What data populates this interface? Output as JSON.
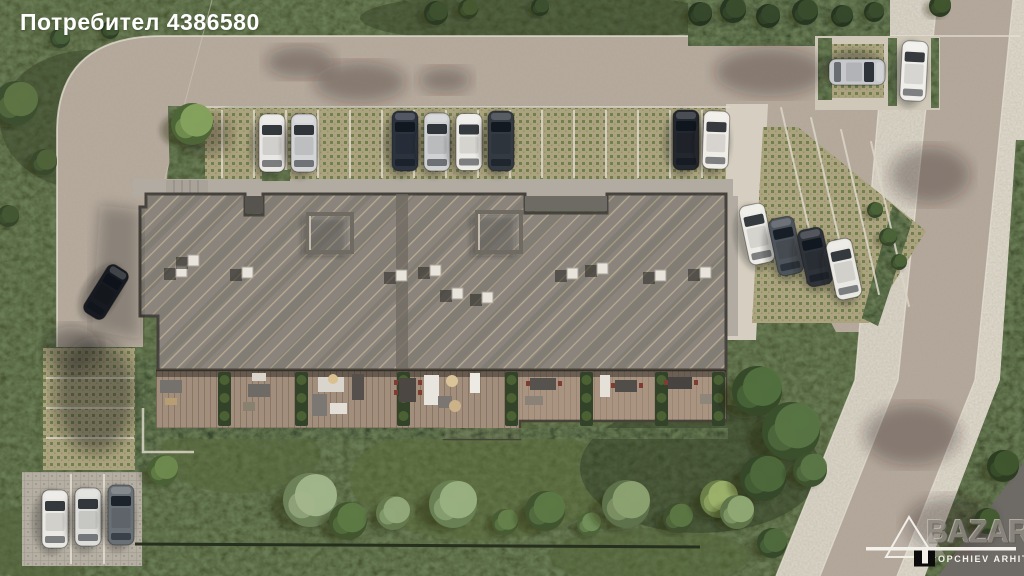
{
  "watermark": {
    "user_label": "Потребител 4386580"
  },
  "logo": {
    "firm_full": "TOPCHIEV ARHITEKTI",
    "firm_initial": "T",
    "firm_rest": "OPCHIEV ARHITEKTI",
    "bazar": "BAZAR"
  },
  "scene": {
    "type": "architectural-aerial-site-render",
    "colors": {
      "grass": "#46522f",
      "grass_dark": "#2f3c22",
      "road": "#b5a89a",
      "sidewalk": "#d8d2c4",
      "paver_tan": "#aba37f",
      "paver_dot_green": "#717f4b",
      "roof": "#8a847c",
      "roof_hatch": "#c7b897",
      "deck": "#a28e7c",
      "hedge": "#35462a",
      "white_line": "#dad4c6"
    },
    "cars": [
      {
        "x": 272,
        "y": 143,
        "a": 0,
        "len": 58,
        "c": "#e9e7e3"
      },
      {
        "x": 304,
        "y": 143,
        "a": 0,
        "len": 58,
        "c": "#d3d4d6"
      },
      {
        "x": 405,
        "y": 141,
        "a": 0,
        "len": 60,
        "c": "#2c333f"
      },
      {
        "x": 437,
        "y": 142,
        "a": 0,
        "len": 58,
        "c": "#cfd1d3"
      },
      {
        "x": 469,
        "y": 142,
        "a": 0,
        "len": 57,
        "c": "#edebe6"
      },
      {
        "x": 501,
        "y": 141,
        "a": 0,
        "len": 60,
        "c": "#343a42"
      },
      {
        "x": 686,
        "y": 140,
        "a": 0,
        "len": 60,
        "c": "#23272e"
      },
      {
        "x": 716,
        "y": 140,
        "a": 2,
        "len": 58,
        "c": "#f0ede7"
      },
      {
        "x": 857,
        "y": 72,
        "a": 90,
        "len": 56,
        "c": "#c6c8cb"
      },
      {
        "x": 914,
        "y": 71,
        "a": 3,
        "len": 60,
        "c": "#f0eee9"
      },
      {
        "x": 757,
        "y": 234,
        "a": -12,
        "len": 60,
        "c": "#edebe5"
      },
      {
        "x": 786,
        "y": 246,
        "a": -12,
        "len": 58,
        "c": "#4d545b"
      },
      {
        "x": 815,
        "y": 257,
        "a": -12,
        "len": 58,
        "c": "#2e333a"
      },
      {
        "x": 844,
        "y": 269,
        "a": -12,
        "len": 60,
        "c": "#eae8e2"
      },
      {
        "x": 55,
        "y": 519,
        "a": 0,
        "len": 58,
        "c": "#eae8e3"
      },
      {
        "x": 88,
        "y": 517,
        "a": 0,
        "len": 58,
        "c": "#ddddd9"
      },
      {
        "x": 121,
        "y": 515,
        "a": 0,
        "len": 60,
        "c": "#697076"
      },
      {
        "x": 106,
        "y": 292,
        "a": 32,
        "len": 56,
        "w": 24,
        "c": "#171b21"
      }
    ],
    "trees": [
      [
        192,
        124,
        21,
        "#86a45e",
        "#4e6637"
      ],
      [
        16,
        103,
        22,
        "#5f7544",
        "#3c5030"
      ],
      [
        44,
        162,
        13,
        "#50643a",
        "#38492c"
      ],
      [
        8,
        216,
        11,
        "#455834",
        "#35462a"
      ],
      [
        60,
        38,
        10,
        "#49613a",
        "#33452b"
      ],
      [
        110,
        30,
        9,
        "#415834",
        "#2e3f26"
      ],
      [
        163,
        470,
        15,
        "#6f8a4f",
        "#4a6136"
      ],
      [
        310,
        500,
        27,
        "#a3b68c",
        "#6d8158"
      ],
      [
        348,
        521,
        19,
        "#5e7a45",
        "#42552f"
      ],
      [
        393,
        513,
        17,
        "#93aa7c",
        "#647a4e"
      ],
      [
        453,
        504,
        24,
        "#9ab081",
        "#688053"
      ],
      [
        505,
        522,
        13,
        "#66814b",
        "#475c33"
      ],
      [
        545,
        511,
        20,
        "#5d7a46",
        "#415430"
      ],
      [
        589,
        524,
        12,
        "#73905a",
        "#4d6439"
      ],
      [
        626,
        504,
        24,
        "#8da271",
        "#5d714a"
      ],
      [
        678,
        518,
        15,
        "#5c7743",
        "#404f2f"
      ],
      [
        719,
        499,
        19,
        "#9cb26b",
        "#6b7f49"
      ],
      [
        757,
        391,
        25,
        "#53713f",
        "#364a2a"
      ],
      [
        791,
        431,
        29,
        "#587544",
        "#3a4f2c"
      ],
      [
        763,
        478,
        23,
        "#4e6a3c",
        "#35482a"
      ],
      [
        810,
        470,
        17,
        "#5b7747",
        "#3e522f"
      ],
      [
        737,
        512,
        17,
        "#90a974",
        "#5f7549"
      ],
      [
        772,
        543,
        15,
        "#506c3d",
        "#37492b"
      ],
      [
        1003,
        466,
        16,
        "#40562f",
        "#2c3d22"
      ],
      [
        987,
        521,
        13,
        "#465c33",
        "#303f24"
      ],
      [
        436,
        13,
        12,
        "#3f5230",
        "#2b3a21"
      ],
      [
        468,
        9,
        10,
        "#475a31",
        "#303f23"
      ],
      [
        540,
        7,
        9,
        "#3d5130",
        "#2a3921"
      ],
      [
        700,
        14,
        12,
        "#374a2c",
        "#263520"
      ],
      [
        733,
        10,
        13,
        "#3a4e2e",
        "#283721"
      ],
      [
        768,
        16,
        12,
        "#374a2c",
        "#263520"
      ],
      [
        805,
        12,
        13,
        "#3a4e2e",
        "#283721"
      ],
      [
        842,
        16,
        11,
        "#374a2c",
        "#263520"
      ],
      [
        874,
        12,
        10,
        "#3a4e2e",
        "#283721"
      ],
      [
        940,
        6,
        11,
        "#41552f",
        "#2d3c23"
      ],
      [
        875,
        210,
        8,
        "#4c6438",
        "#35462a"
      ],
      [
        888,
        237,
        9,
        "#4c6438",
        "#35462a"
      ],
      [
        899,
        262,
        8,
        "#4c6438",
        "#35462a"
      ]
    ],
    "planters": [
      218,
      295,
      397,
      505,
      580,
      655,
      712
    ],
    "vents": [
      [
        176,
        266
      ],
      [
        188,
        255
      ],
      [
        242,
        267
      ],
      [
        396,
        270
      ],
      [
        430,
        265
      ],
      [
        452,
        288
      ],
      [
        482,
        292
      ],
      [
        567,
        268
      ],
      [
        597,
        263
      ],
      [
        655,
        270
      ],
      [
        700,
        267
      ]
    ],
    "parking_lines": {
      "top_row": {
        "x0": 222,
        "step": 32,
        "count": 16,
        "y0": 110,
        "y1": 178
      },
      "fan": [
        [
          800,
          190
        ],
        [
          830,
          200
        ],
        [
          860,
          212
        ],
        [
          890,
          224
        ]
      ],
      "fan_angle": -13,
      "left_strip_ys": [
        378,
        408,
        438
      ],
      "left_strip_x0": 46,
      "left_strip_x1": 134,
      "bottom_pad_xs": [
        71,
        104
      ],
      "bottom_pad_y0": 474,
      "bottom_pad_y1": 564
    }
  }
}
